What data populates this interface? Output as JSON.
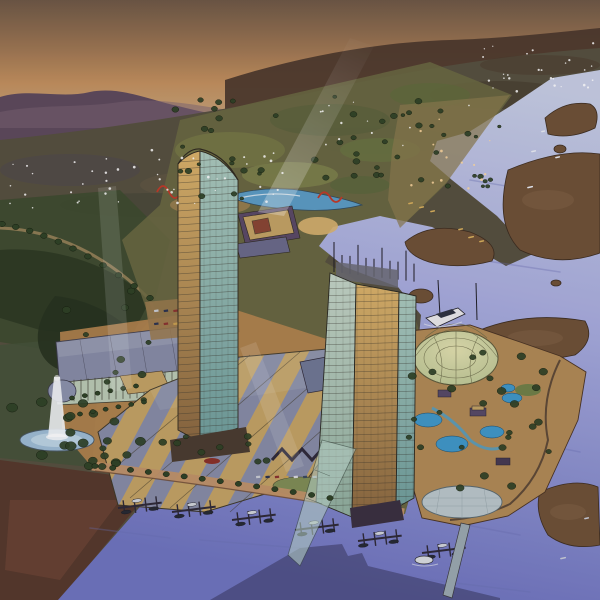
{
  "meta": {
    "title": "Aerial watercolor rendering of a waterfront casino resort master plan at dusk",
    "medium": "pen-and-ink with watercolor",
    "view": "bird's-eye aerial perspective looking up-river",
    "time_of_day": "dusk"
  },
  "scene": {
    "sky": "sunset sky with orange glow over distant purple mountains",
    "valley": "darkening valley plain dotted with scattered house lights",
    "river": "wide river with lavender water and brown tidal marsh islands",
    "tower_1": "curved-crown glass hotel tower, gold west face and teal glass east face",
    "tower_2": "taller glass hotel tower with rooftop masts and sloped glass atrium skirt",
    "casino_roofs": "fan of angular sail roofs alternating tan and slate",
    "glass_dome": "pale glass conservatory dome beside tower 2",
    "waterpark": "pool and waterpark peninsula with winding paths and trees",
    "village": "terraced red-roofed village along the upper riverbank",
    "lagoon": "theme-park lagoon with water rides and red coaster loops",
    "marina": "marina basin with finger docks, boats and a long pier",
    "fountain": "circular fountain pool with tall white water jet",
    "beams": "pale searchlight beams rising from the resort",
    "shadow": "tower shadow cast across the marina water",
    "yacht": "white excursion yacht moored in the cove"
  },
  "palette": {
    "sky_top": "#6d5846",
    "sky_glow": "#c2905e",
    "sky_horizon": "#bfa083",
    "ridge": "#4a372b",
    "mountains": "#5d4a5c",
    "terrain": "#56503f",
    "fields": "#3d4b2f",
    "water_light": "#c6cde4",
    "water_mid": "#a9aede",
    "water_deep": "#6e74bf",
    "marsh": "#6e5137",
    "gold_light": "#d9b26a",
    "gold_dark": "#8a6840",
    "glass_light": "#aac9bd",
    "glass_dark": "#6f9e9c",
    "pale_light": "#c3d4c6",
    "pale_dark": "#8fae9e",
    "roof_tan": "#c2a264",
    "roof_slate": "#868ca6",
    "arcade": "#b9c9b4",
    "dome_light": "#e0dfae",
    "dome_dark": "#b8c492",
    "pool_blue": "#3f97c8",
    "lagoon": "#5b9cc4",
    "village_wall": "#d7c08f",
    "village_roof": "#8d4a30",
    "plaza_tan": "#b5854f",
    "promenade": "#c09268",
    "quay": "#55392c",
    "foliage": "#2e4226",
    "fountain_jet": "#f4f7fa",
    "oval_pad": "#b9c6ca",
    "pier": "#9aa8b0",
    "shadow": "#262443",
    "window_light": "#ffd9a0"
  }
}
